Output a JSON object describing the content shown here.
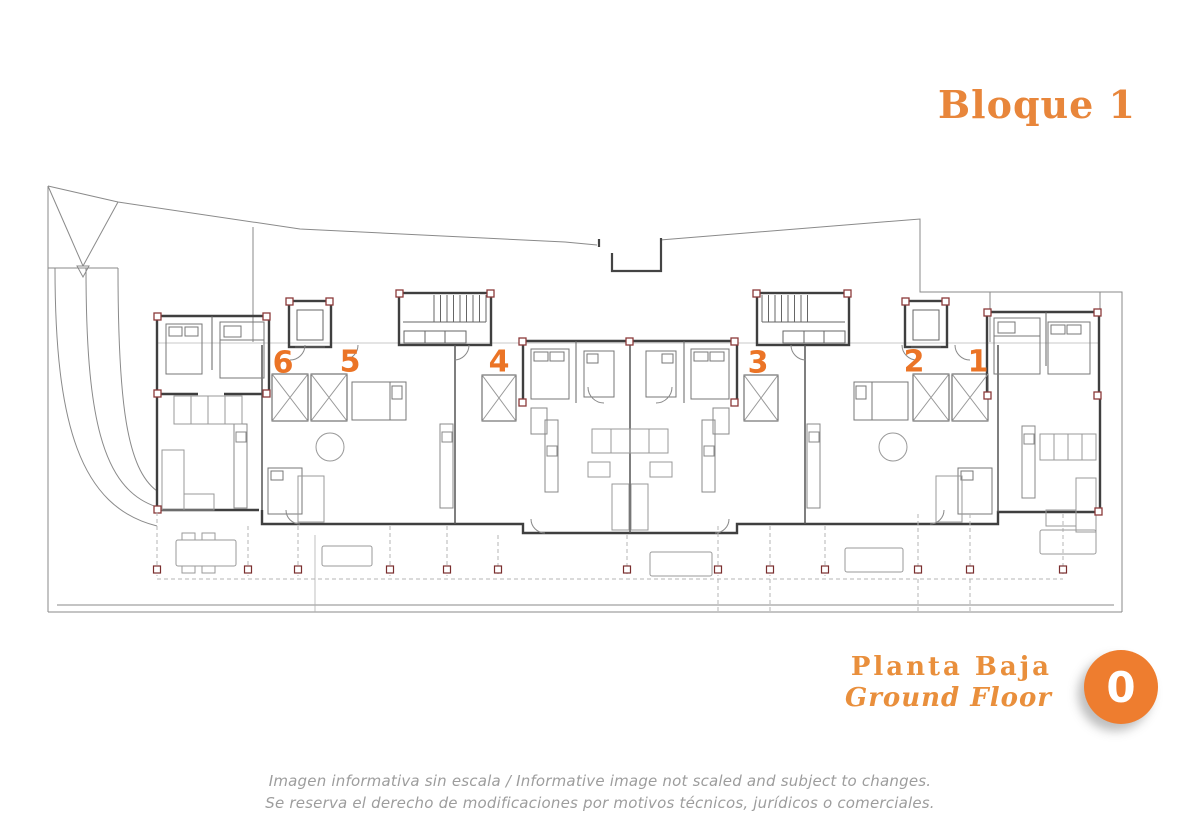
{
  "colors": {
    "accent-title": "#E8863B",
    "accent-number": "#EB7426",
    "accent-label": "#E98F3C",
    "accent-badge": "#EE7D2F",
    "plan-line-dark": "#3f3f3f",
    "plan-line-light": "#999999",
    "plan-pillar": "#8b3a3a",
    "disclaimer-gray": "#9d9d9d"
  },
  "header": {
    "title": "Bloque 1"
  },
  "plan": {
    "units": [
      {
        "label": "6"
      },
      {
        "label": "5"
      },
      {
        "label": "4"
      },
      {
        "label": "3"
      },
      {
        "label": "2"
      },
      {
        "label": "1"
      }
    ]
  },
  "footer": {
    "floor_label_es": "Planta Baja",
    "floor_label_en": "Ground Floor",
    "floor_badge": "0"
  },
  "disclaimer": {
    "line1": "Imagen informativa sin escala /  Informative image not scaled and subject to changes.",
    "line2": "Se reserva el derecho de modificaciones por motivos técnicos, jurídicos o comerciales."
  }
}
